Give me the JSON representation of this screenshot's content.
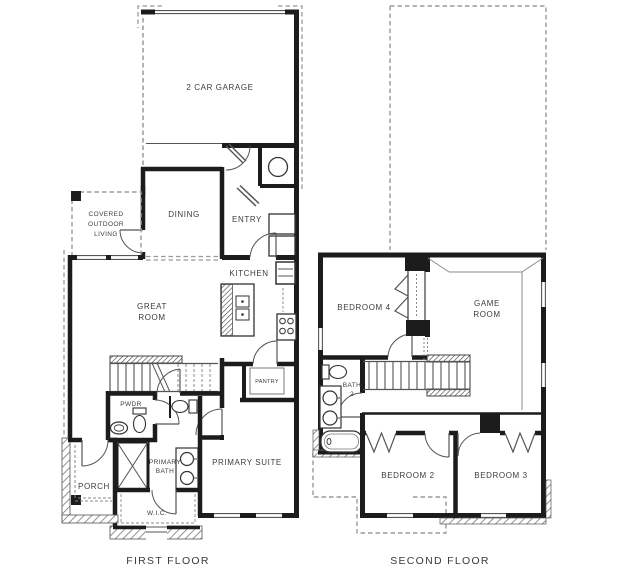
{
  "plan": {
    "colors": {
      "wall": "#1c1c1c",
      "thin_line": "#555555",
      "dashed_line": "#9a9a9a",
      "hatch": "#777777",
      "label_text": "#3d3d3d",
      "background": "#ffffff"
    },
    "first_floor": {
      "title": "FIRST FLOOR",
      "rooms": {
        "garage": "2 CAR GARAGE",
        "covered_outdoor_living": [
          "COVERED",
          "OUTDOOR",
          "LIVING"
        ],
        "dining": "DINING",
        "entry": "ENTRY",
        "kitchen": "KITCHEN",
        "great_room": [
          "GREAT",
          "ROOM"
        ],
        "pantry": "PANTRY",
        "pwdr": "PWDR",
        "primary_bath": [
          "PRIMARY",
          "BATH"
        ],
        "primary_suite": "PRIMARY SUITE",
        "wic": "W.I.C.",
        "porch": "PORCH"
      }
    },
    "second_floor": {
      "title": "SECOND FLOOR",
      "rooms": {
        "bedroom4": "BEDROOM 4",
        "game_room": [
          "GAME",
          "ROOM"
        ],
        "bath2": [
          "BATH",
          "2"
        ],
        "bedroom2": "BEDROOM 2",
        "bedroom3": "BEDROOM 3"
      }
    }
  }
}
